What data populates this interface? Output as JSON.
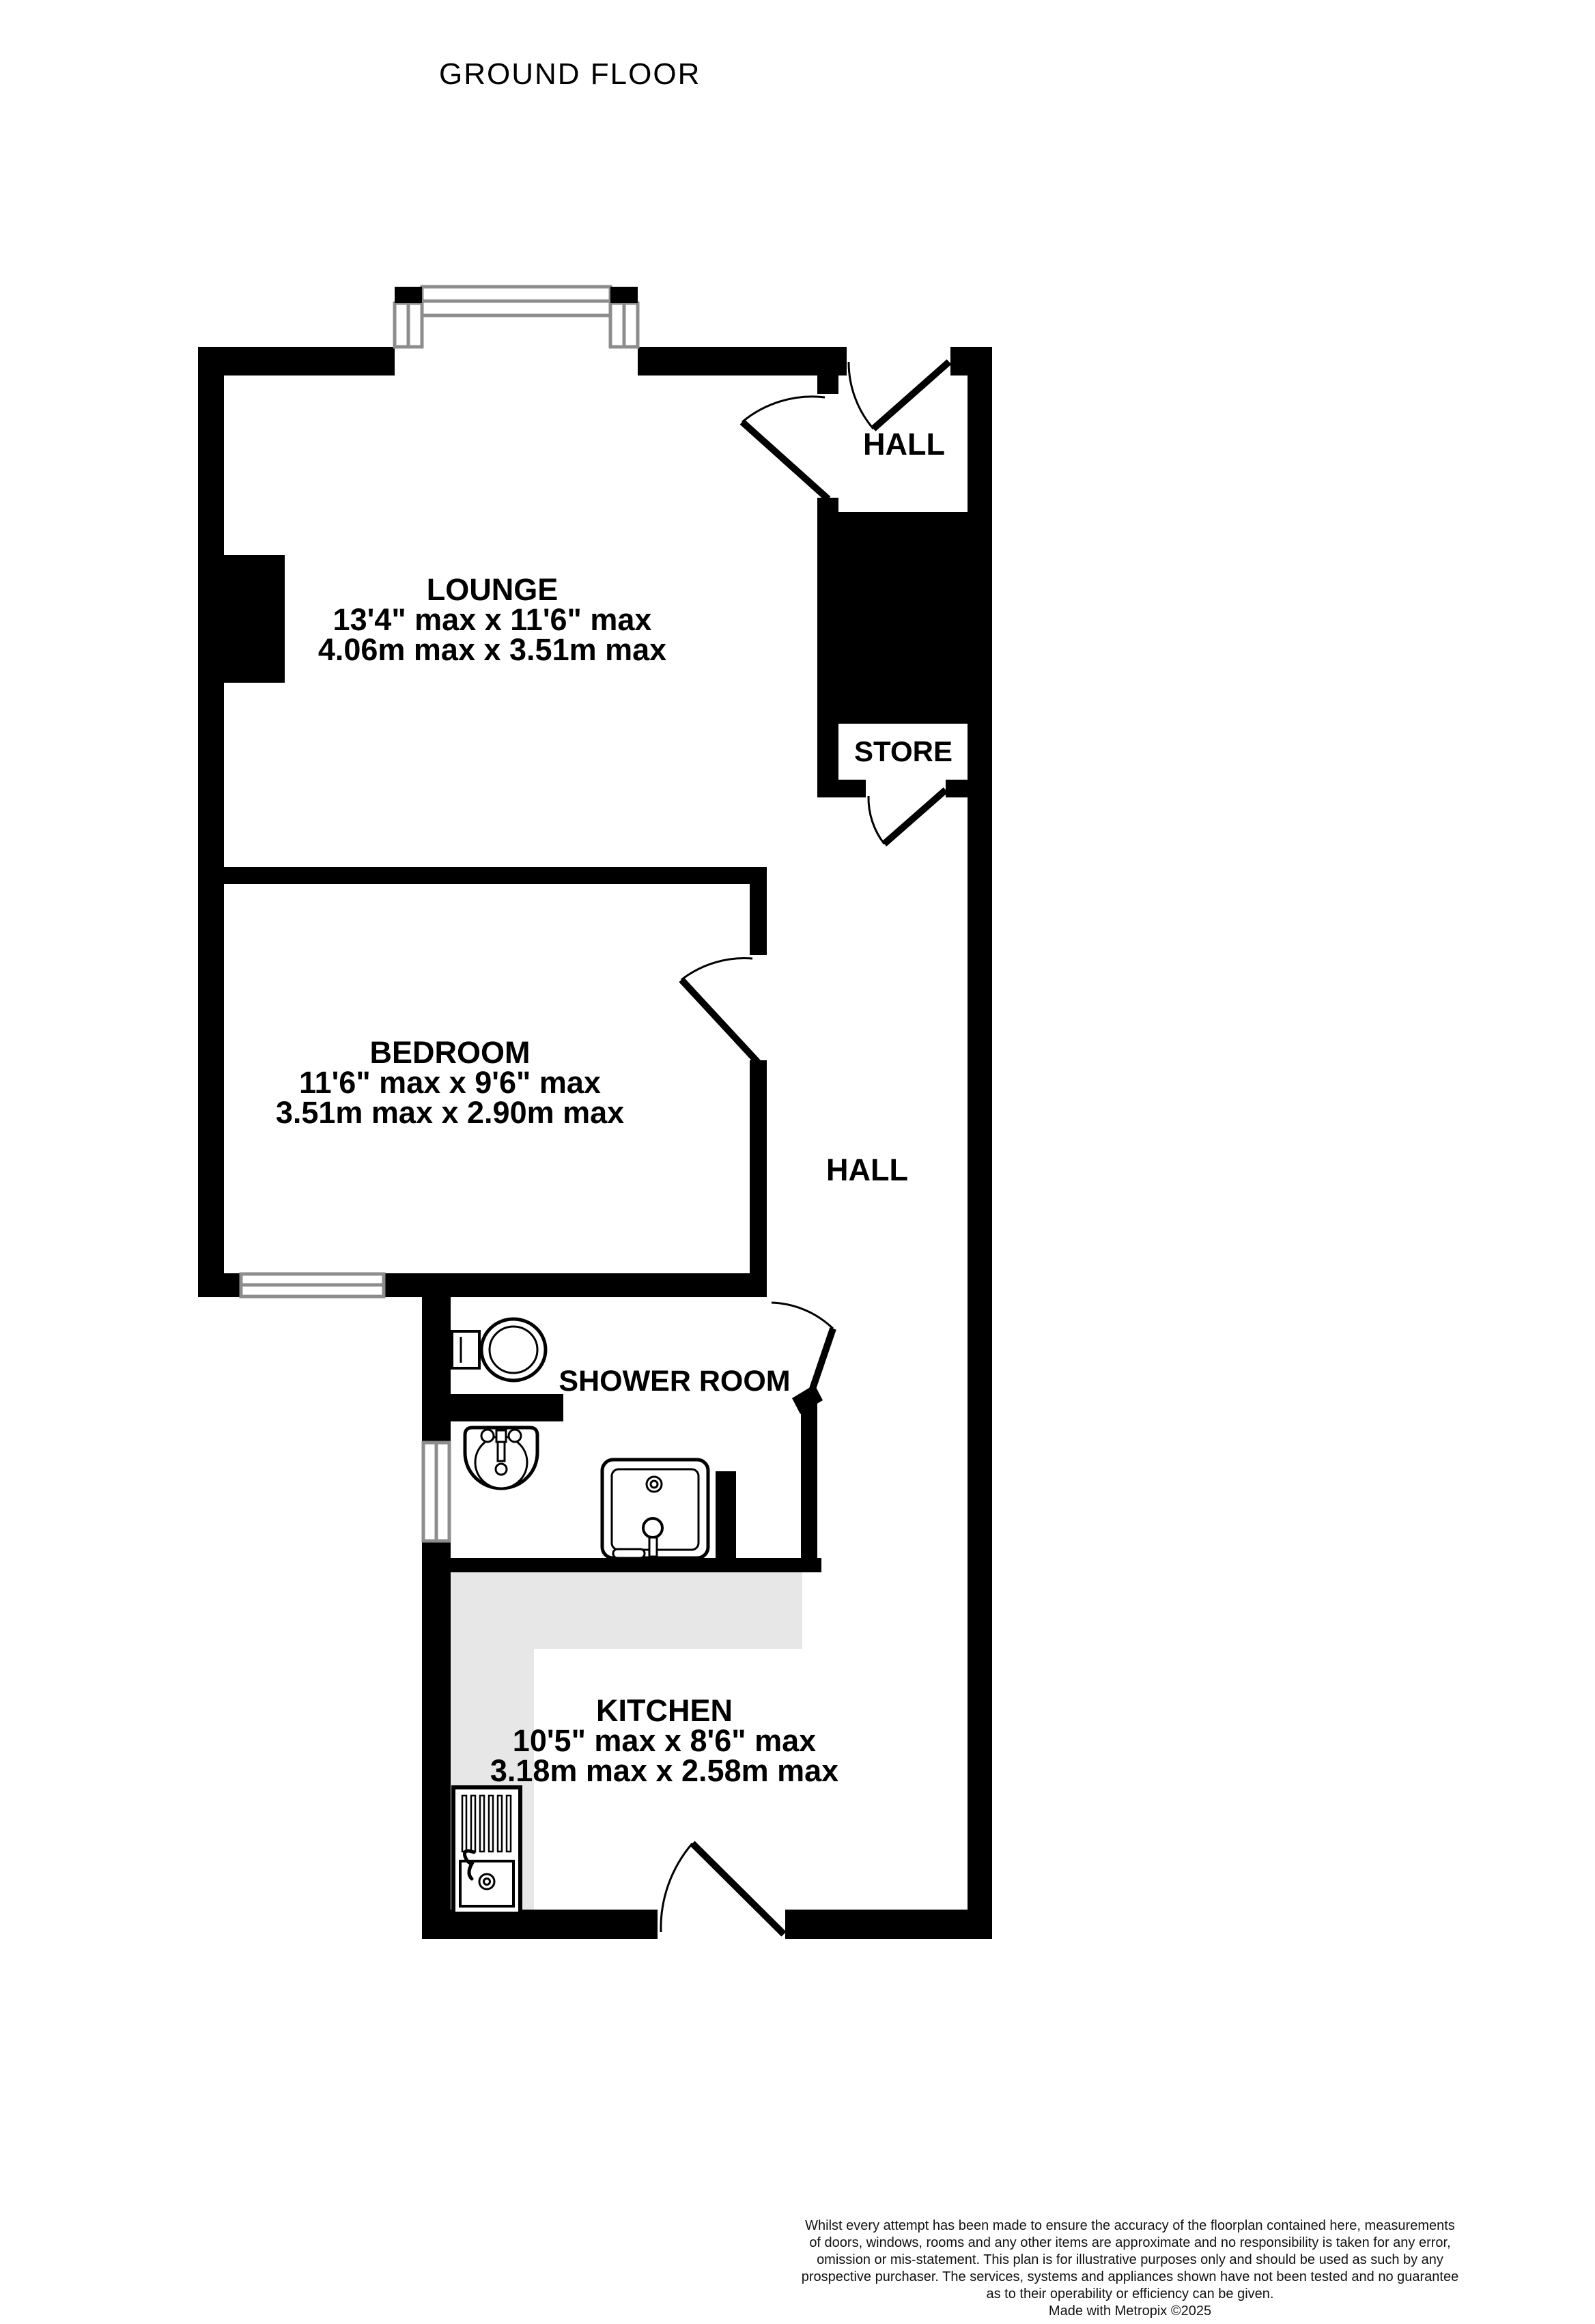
{
  "title": "GROUND FLOOR",
  "colors": {
    "wall": "#000000",
    "counter": "#e7e7e7",
    "window_frame": "#8d8d8d",
    "text": "#000000",
    "background": "#ffffff"
  },
  "rooms": {
    "lounge": {
      "name": "LOUNGE",
      "size_imperial": "13'4\" max x 11'6\" max",
      "size_metric": "4.06m max x 3.51m max"
    },
    "hall_top": {
      "name": "HALL"
    },
    "store": {
      "name": "STORE"
    },
    "bedroom": {
      "name": "BEDROOM",
      "size_imperial": "11'6\" max x 9'6\" max",
      "size_metric": "3.51m max x 2.90m max"
    },
    "hall": {
      "name": "HALL"
    },
    "shower_room": {
      "name": "SHOWER ROOM"
    },
    "kitchen": {
      "name": "KITCHEN",
      "size_imperial": "10'5\" max x 8'6\" max",
      "size_metric": "3.18m max x 2.58m max"
    }
  },
  "fixtures": [
    "toilet",
    "washbasin",
    "shower-tray",
    "kitchen-sink-drainer",
    "bay-window",
    "bedroom-window",
    "shower-window",
    "chimney-breast",
    "kitchen-counter"
  ],
  "footer": {
    "disclaimer_lines": [
      "Whilst every attempt has been made to ensure the accuracy of the floorplan contained here, measurements",
      "of doors, windows, rooms and any other items are approximate and no responsibility is taken for any error,",
      "omission or mis-statement. This plan is for illustrative purposes only and should be used as such by any",
      "prospective purchaser. The services, systems and appliances shown have not been tested and no guarantee",
      "as to their operability or efficiency can be given."
    ],
    "credit": "Made with Metropix ©2025"
  }
}
